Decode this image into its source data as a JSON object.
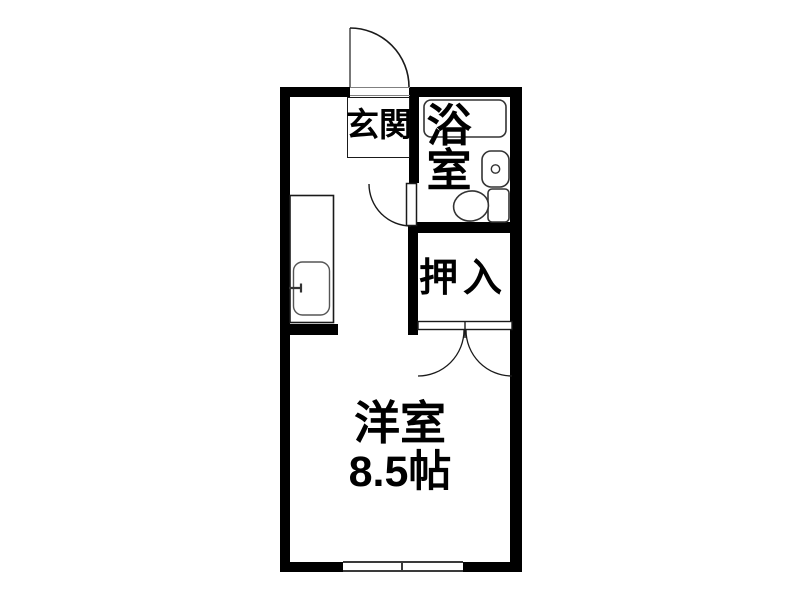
{
  "meta": {
    "type": "floor-plan",
    "description": "Japanese studio apartment floor plan"
  },
  "colors": {
    "background": "#ffffff",
    "wall": "#000000",
    "door_line": "#1a1a1a",
    "fixture_line": "#333333",
    "window_line": "#3a3a3a"
  },
  "rooms": {
    "genkan": {
      "label": "玄関"
    },
    "bathroom": {
      "label_vertical": [
        "浴",
        "室"
      ]
    },
    "closet": {
      "label": "押入"
    },
    "main_room": {
      "label": "洋室",
      "size": "8.5帖"
    }
  },
  "fixtures": {
    "entrance_door": "entrance-swing-door",
    "bathroom_door": "bathroom-swing-door",
    "closet_doors": "closet-double-doors",
    "bathtub": "bathtub",
    "wash_basin": "wash-basin",
    "toilet": "toilet",
    "kitchen_counter": "kitchen-counter",
    "kitchen_sink": "kitchen-sink",
    "kitchen_faucet": "kitchen-faucet",
    "window": "sliding-window"
  }
}
